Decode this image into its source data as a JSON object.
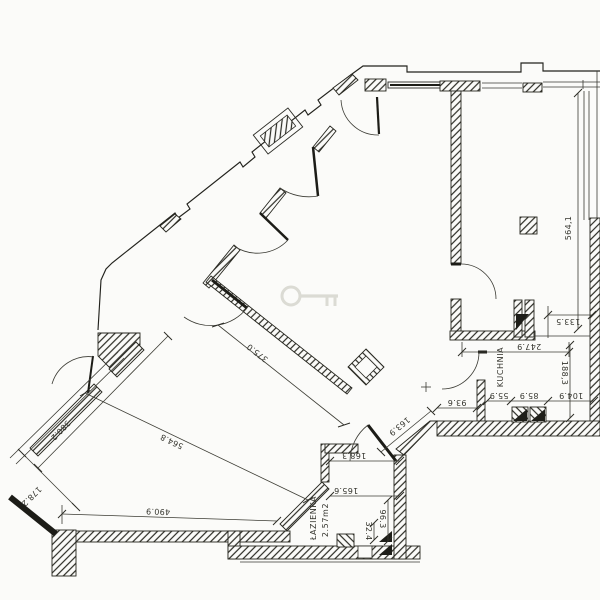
{
  "palette": {
    "paper": "#fbfbf9",
    "ink": "#26261f",
    "watermark": "#dbdbd4"
  },
  "rooms": {
    "kitchen": "KUCHNIA",
    "bathroom": "ŁAZIENKA",
    "bathroom_area": "2.57m2"
  },
  "dims": {
    "right_room_height": "564,1",
    "hall_diagonal": "375.0",
    "living_upper_edge": "380.2",
    "living_diagonal": "564.8",
    "living_bottom": "490.9",
    "living_left": "178.2",
    "passage": "163.9",
    "kitchen_door": "93.6",
    "kitchen_b1": "55.9",
    "kitchen_b2": "85.9",
    "kitchen_b3": "104.9",
    "kitchen_height": "188,3",
    "kitchen_width": "247.9",
    "kitchen_top": "133.5",
    "bath_width_inner": "165.6",
    "bath_width_outer": "168.3",
    "bath_height": "96.3",
    "bath_small": "32.4"
  }
}
